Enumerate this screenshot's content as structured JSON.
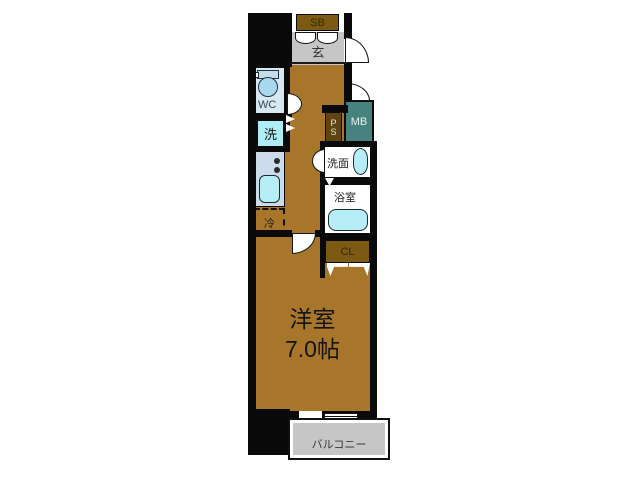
{
  "plan": {
    "title": "apartment-floorplan",
    "labels": {
      "shoe_box": "SB",
      "entrance": "玄",
      "toilet": "WC",
      "washer": "洗",
      "pipe_space_p": "P",
      "pipe_space_s": "S",
      "meter_box": "MB",
      "washroom": "洗面",
      "bathroom": "浴室",
      "closet": "CL",
      "refrigerator": "冷",
      "main_room_name": "洋室",
      "main_room_size": "7.0帖",
      "balcony": "バルコニー"
    },
    "colors": {
      "wall": "#0a0a0a",
      "floor": "#a8762a",
      "genkan": "#c6c6c6",
      "balcony_gray": "#c6c6c6",
      "cabinet_brown": "#7d5a14",
      "ps_brown": "#5f4410",
      "meter_box_teal": "#47827f",
      "fixture_blue": "#b7edf7",
      "counter_blue": "#cddcea",
      "wc_room_blue": "#d8e8f2",
      "toilet_bowl_blue": "#a9d9ee"
    }
  }
}
